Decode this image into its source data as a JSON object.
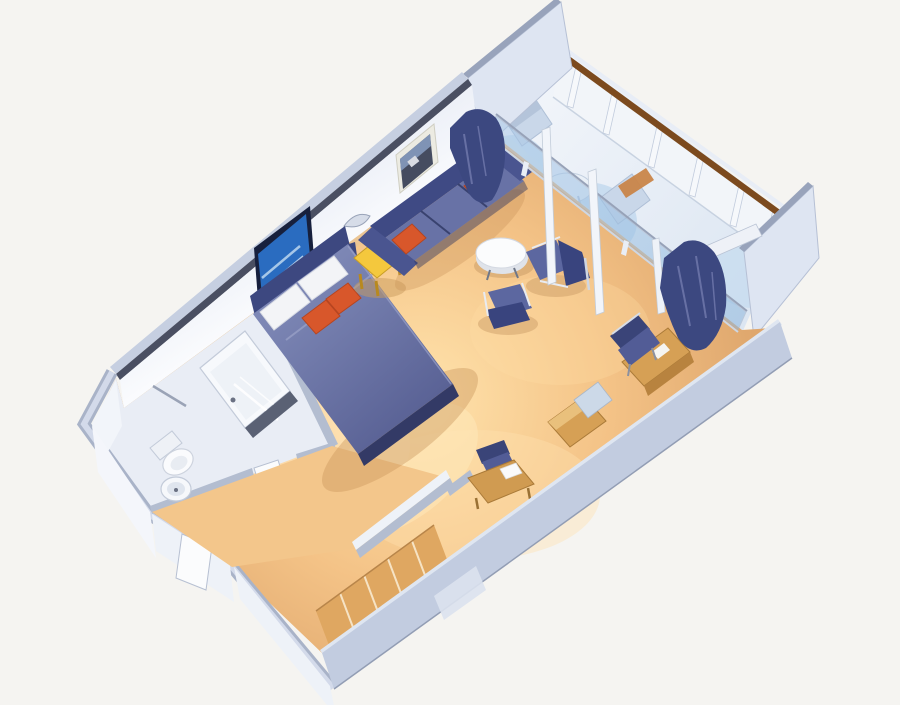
{
  "scene": {
    "type": "3d-floorplan-render",
    "subject": "cruise-ship-suite-with-private-balcony",
    "projection": "isometric-cutaway",
    "rooms": [
      {
        "id": "bedroom",
        "contents": [
          "double-bed",
          "headboard",
          "white-pillows",
          "orange-accent-pillows",
          "yellow-nightstand",
          "tv"
        ]
      },
      {
        "id": "living-area",
        "contents": [
          "navy-sofa",
          "orange-sofa-pillows",
          "round-coffee-table",
          "armchair-east",
          "armchair-south",
          "desk",
          "desk-chair",
          "minibar-cabinet",
          "vanity-desk",
          "vanity-chair",
          "picture-frame",
          "wall-sconce"
        ]
      },
      {
        "id": "bathroom",
        "contents": [
          "bathtub",
          "toilet",
          "round-sink",
          "towel-bar",
          "bathroom-door"
        ]
      },
      {
        "id": "entry-corridor",
        "contents": [
          "entry-door",
          "wardrobe-shelves"
        ]
      },
      {
        "id": "balcony",
        "contents": [
          "glass-sliding-wall",
          "navy-curtains",
          "balcony-chairs",
          "balcony-table",
          "wood-lounger",
          "railing-with-handrail",
          "privacy-dividers"
        ]
      }
    ]
  },
  "colors": {
    "background": "#f5f4f1",
    "floor_bright": "#ffe3ac",
    "floor_mid": "#f4c387",
    "floor_deep": "#dfa76d",
    "corridor_floor": "#f3c68b",
    "closet_wood": "#dfa761",
    "bathroom_floor": "#e9edf5",
    "wall_face": "#eef1f8",
    "wall_face_light": "#fbfcfe",
    "wall_cap_dark": "#4a4f62",
    "wall_cap_light": "#a9b3c8",
    "wall_outer_band": "#c6cfe1",
    "exterior_wall": "#c2cce0",
    "partition_cap": "#b3bdd0",
    "divider_face": "#dee5f2",
    "balcony_floor_near": "#f2f5fa",
    "balcony_floor_far": "#dce6f2",
    "handrail_wood": "#7c4a1e",
    "glass_blue": "#aac9e8",
    "glass_deep": "#8fb8de",
    "navy_dark": "#3f4a84",
    "navy_mid": "#5c67a0",
    "navy_deep": "#2e3660",
    "headboard_navy": "#3d4880",
    "duvet_light": "#7e88b6",
    "duvet_dark": "#565e92",
    "pillow_white": "#f3f4f7",
    "pillow_orange": "#d8572b",
    "table_yellow": "#f4c83d",
    "wood_furniture": "#d6a055",
    "fixture_white": "#f7f9fc",
    "fixture_outline": "#c3cbd9",
    "tv_frame": "#17203d",
    "tv_screen": "#2a6cc0",
    "curtain_navy": "#3c4880",
    "chrome": "#e8ebf1",
    "balcony_furniture": "#c9d7e9",
    "balcony_wood": "#c98549"
  }
}
